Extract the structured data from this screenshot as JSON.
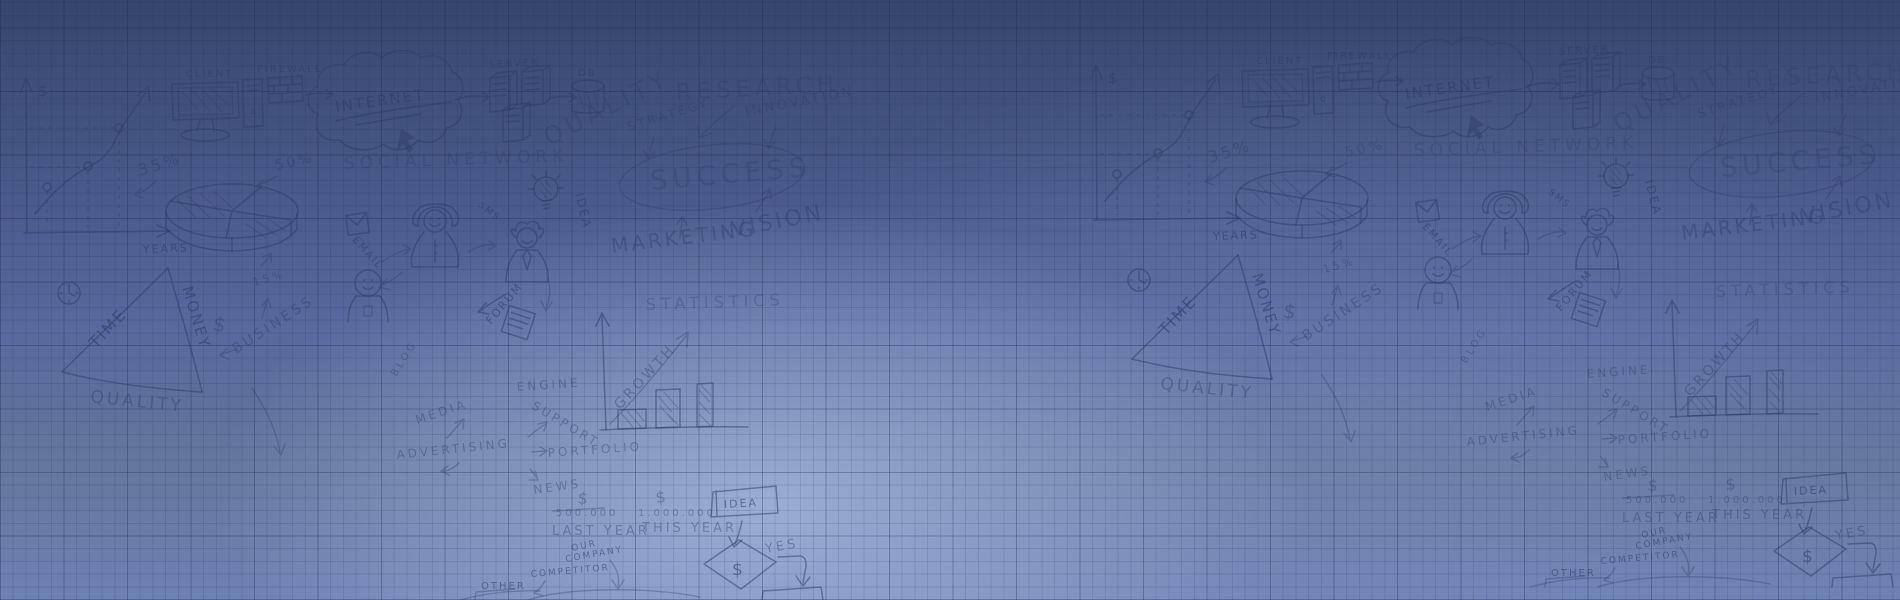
{
  "meta": {
    "description": "Blue graph-paper hero banner covered with hand-drawn business strategy doodles, pattern repeated twice horizontally"
  },
  "colors": {
    "background_top": "#35456b",
    "background_mid": "#49598a",
    "background_bottom": "#6d82b4",
    "center_highlight": "#93a9da",
    "grid_line": "#1a284a",
    "ink": "#2d3d68"
  },
  "labels": {
    "dollar": "$",
    "years": "YEARS",
    "pct35": "35%",
    "pct50": "50%",
    "pct15": "15%",
    "client": "CLIENT",
    "firewall": "FIREWALL",
    "internet": "INTERNET",
    "server": "SERVER",
    "db": "DB",
    "social_network": "SOCIAL NETWORK",
    "quality_big": "QUALITY",
    "strategy": "STRATEGY",
    "research": "RESEARCH",
    "innovation": "INNOVATION",
    "success": "SUCCESS",
    "vision": "VISION",
    "marketing": "MARKETING",
    "idea": "IDEA",
    "email": "EMAIL",
    "sms": "SMS",
    "time": "TIME",
    "money": "MONEY",
    "quality": "QUALITY",
    "business": "BUSINESS",
    "forum": "FORUM",
    "statistics": "STATISTICS",
    "growth": "GROWTH",
    "engine": "ENGINE",
    "support": "SUPPORT",
    "portfolio": "PORTFOLIO",
    "media": "MEDIA",
    "advertising": "ADVERTISING",
    "blog": "BLOG",
    "news": "NEWS",
    "last_year_value": "500.000",
    "this_year_value": "1.000.000",
    "last_year": "LAST YEAR",
    "this_year": "THIS YEAR",
    "our": "OUR",
    "company": "COMPANY",
    "competitor": "COMPETITOR",
    "other": "OTHER",
    "yes": "YES"
  }
}
